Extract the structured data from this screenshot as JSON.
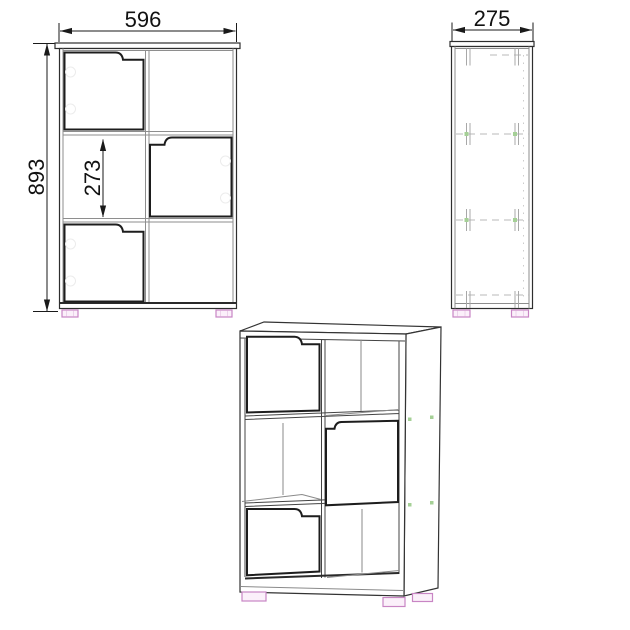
{
  "drawing": {
    "front_view": {
      "width_label": "596",
      "height_label": "893",
      "cell_label": "273"
    },
    "side_view": {
      "depth_label": "275"
    },
    "colors": {
      "background": "#ffffff",
      "outline": "#2e2e2e",
      "frame": "#8e8e8e",
      "door": "#1d1d1d",
      "hidden_line": "#b9b9b9",
      "dimension_text": "#111111",
      "connector_dot_green": "#a5d096",
      "foot_outline_pink": "#c885c4",
      "foot_fill_pink": "#fbf0fa"
    }
  }
}
